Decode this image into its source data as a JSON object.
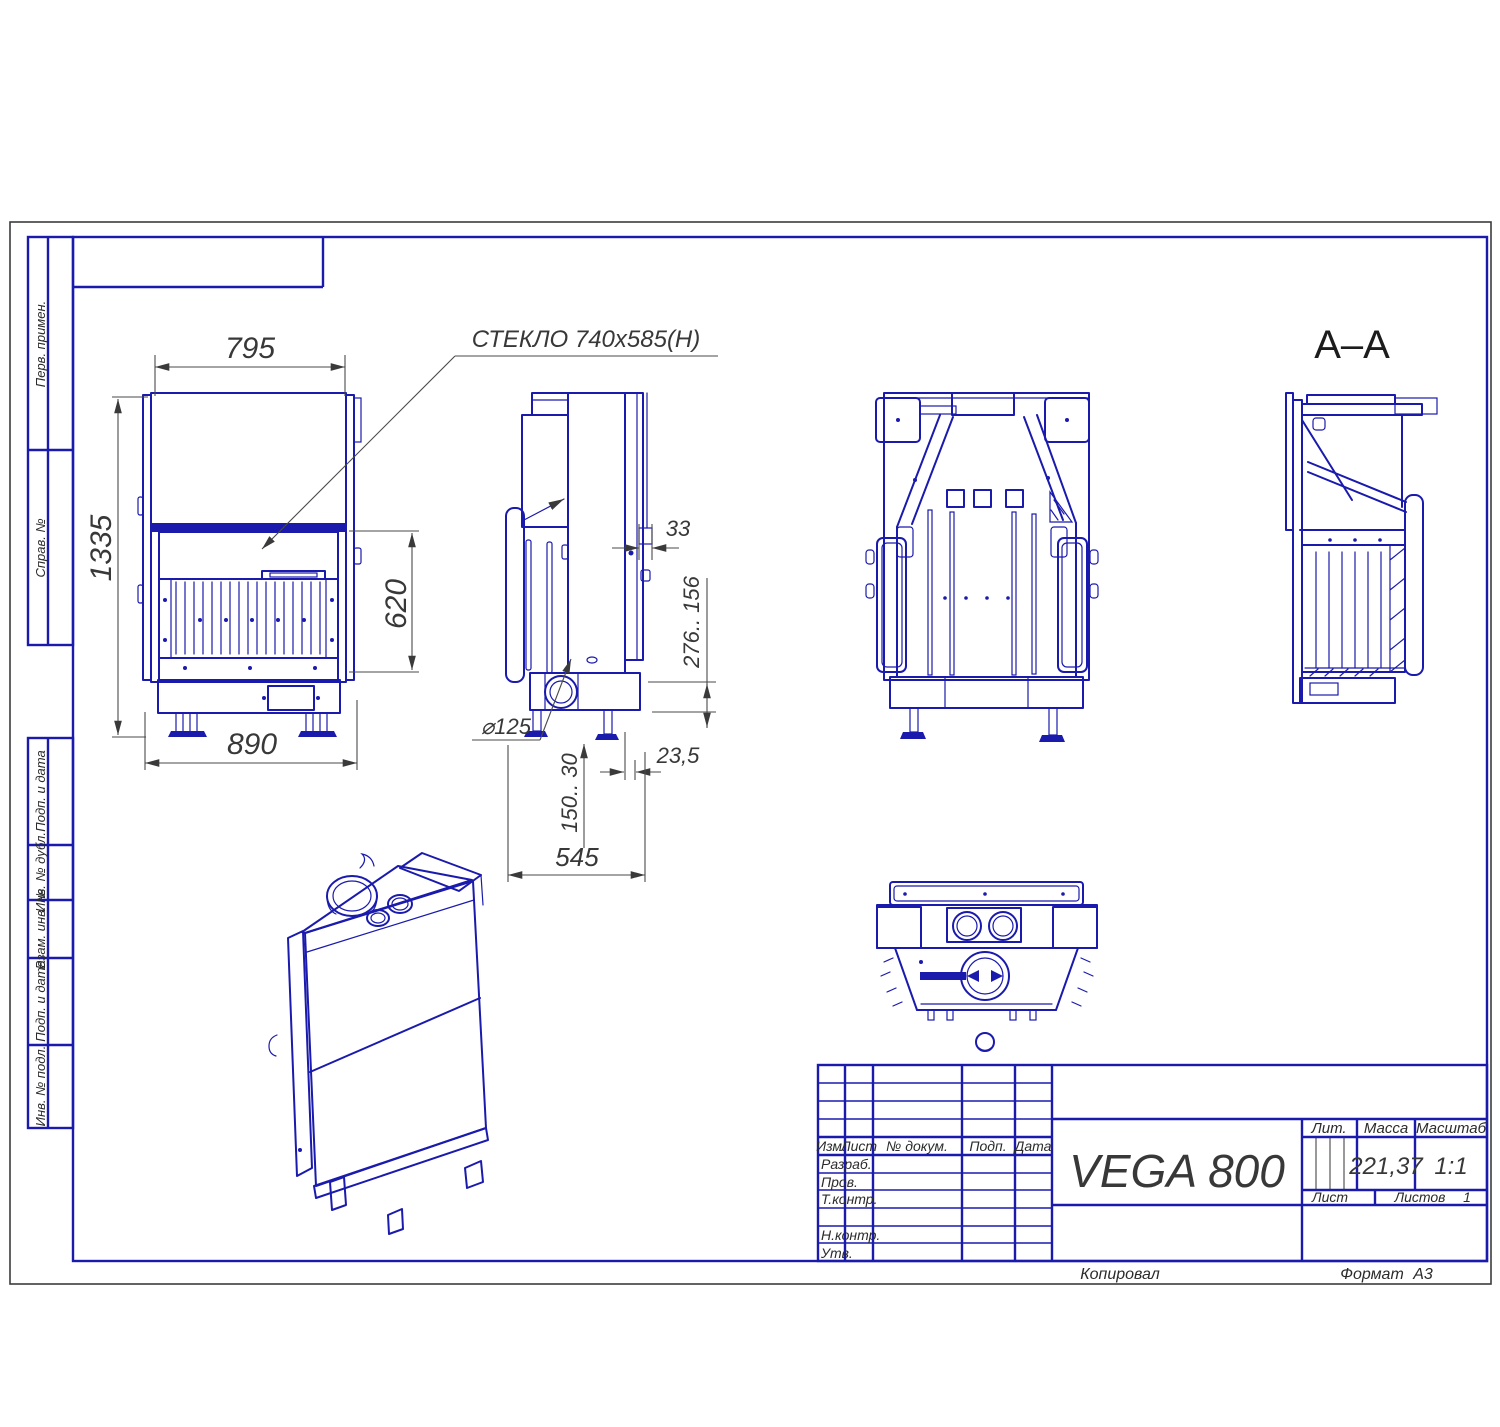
{
  "drawing": {
    "doc_name": "VEGA 800",
    "accent_color": "#1a1aad",
    "dim_color": "#4a4a4a"
  },
  "margin_labels": [
    "Перв. примен.",
    "Справ. №",
    "Подп. и дата",
    "Инв. № дубл.",
    "Взам. инв. №",
    "Подп. и дата",
    "Инв. № подл."
  ],
  "callouts": {
    "glass": "СТЕКЛО  740x585(Н)"
  },
  "section": {
    "label": "А–А"
  },
  "dimensions": {
    "front_width": "795",
    "front_height": "1335",
    "door_height": "620",
    "base_width": "890",
    "wall_thickness": "33",
    "height_range": "276.. 156",
    "flue_diameter": "⌀125",
    "leg_range": "150.. 30",
    "offset": "23,5",
    "depth": "545"
  },
  "title_block": {
    "header_cols": [
      "Изм.",
      "Лист",
      "№ докум.",
      "Подп.",
      "Дата"
    ],
    "sign_rows": [
      "Разраб.",
      "Пров.",
      "Т.контр.",
      "Н.контр.",
      "Утв."
    ],
    "doc_name": "VEGA 800",
    "lit_label": "Лит.",
    "mass_label": "Масса",
    "scale_label": "Масштаб",
    "mass_value": "221,37",
    "scale_value": "1:1",
    "sheet_label": "Лист",
    "sheets_label": "Листов",
    "sheets_value": "1"
  },
  "footer": {
    "copied": "Копировал",
    "format_label": "Формат",
    "format_value": "А3"
  }
}
